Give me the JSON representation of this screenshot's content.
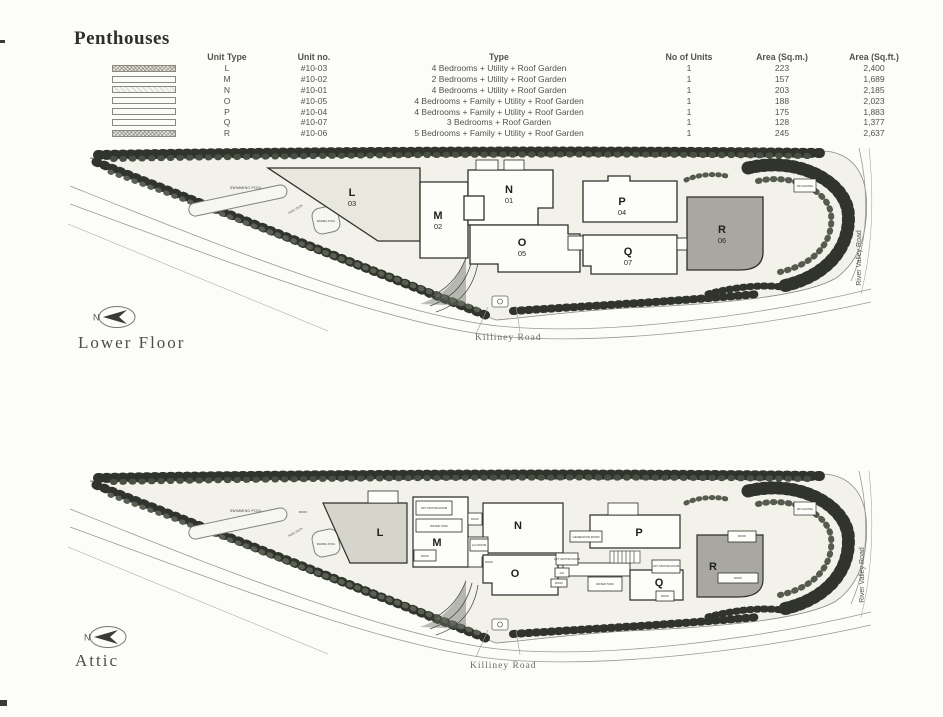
{
  "page": {
    "title": "Penthouses"
  },
  "table": {
    "headers": [
      "Unit Type",
      "Unit no.",
      "Type",
      "No of Units",
      "Area (Sq.m.)",
      "Area (Sq.ft.)"
    ],
    "rows": [
      {
        "swatch": "stipple",
        "unit_type": "L",
        "unit_no": "#10-03",
        "type": "4 Bedrooms + Utility + Roof Garden",
        "units": "1",
        "sqm": "223",
        "sqft": "2,400"
      },
      {
        "swatch": "plain",
        "unit_type": "M",
        "unit_no": "#10-02",
        "type": "2 Bedrooms + Utility + Roof Garden",
        "units": "1",
        "sqm": "157",
        "sqft": "1,689"
      },
      {
        "swatch": "light",
        "unit_type": "N",
        "unit_no": "#10-01",
        "type": "4 Bedrooms + Utility + Roof Garden",
        "units": "1",
        "sqm": "203",
        "sqft": "2,185"
      },
      {
        "swatch": "plain",
        "unit_type": "O",
        "unit_no": "#10-05",
        "type": "4 Bedrooms + Family + Utility + Roof Garden",
        "units": "1",
        "sqm": "188",
        "sqft": "2,023"
      },
      {
        "swatch": "plain",
        "unit_type": "P",
        "unit_no": "#10-04",
        "type": "4 Bedrooms + Family + Utility + Roof Garden",
        "units": "1",
        "sqm": "175",
        "sqft": "1,883"
      },
      {
        "swatch": "plain",
        "unit_type": "Q",
        "unit_no": "#10-07",
        "type": "3 Bedrooms + Roof Garden",
        "units": "1",
        "sqm": "128",
        "sqft": "1,377"
      },
      {
        "swatch": "stipple",
        "unit_type": "R",
        "unit_no": "#10-06",
        "type": "5 Bedrooms + Family + Utility + Roof Garden",
        "units": "1",
        "sqm": "245",
        "sqft": "2,637"
      }
    ]
  },
  "lower_floor": {
    "label": "Lower Floor",
    "compass": "N",
    "roads": {
      "killiney": "Killiney Road",
      "river_valley": "River Valley Road"
    },
    "labels": {
      "swimming_pool": "SWIMMING POOL",
      "pool_deck": "POOL DECK",
      "wading_pool": "WADING POOL",
      "bin_centre": "BIN CENTRE"
    },
    "units": [
      {
        "letter": "L",
        "number": "03"
      },
      {
        "letter": "M",
        "number": "02"
      },
      {
        "letter": "N",
        "number": "01"
      },
      {
        "letter": "O",
        "number": "05"
      },
      {
        "letter": "P",
        "number": "04"
      },
      {
        "letter": "Q",
        "number": "07"
      },
      {
        "letter": "R",
        "number": "06"
      }
    ]
  },
  "attic": {
    "label": "Attic",
    "compass": "N",
    "roads": {
      "killiney": "Killiney Road",
      "river_valley": "River Valley Road"
    },
    "labels": {
      "swimming_pool": "SWIMMING POOL",
      "pool_deck": "POOL DECK",
      "wading_pool": "WADING POOL",
      "bin_centre": "BIN CENTRE"
    },
    "units": [
      "L",
      "M",
      "N",
      "O",
      "P",
      "Q",
      "R"
    ],
    "room_labels": [
      "LIFT MOTOR ROOM",
      "WATER TANK",
      "ROOF",
      "ROOF",
      "A/C ROOM",
      "ROOF",
      "GENERATOR ROOM",
      "LIFT MOTOR ROOM",
      "A/C",
      "ROOF",
      "WATER TANK",
      "LIFT MOTOR ROOM",
      "ROOF",
      "ROOF",
      "ROOF",
      "ROOF"
    ]
  }
}
